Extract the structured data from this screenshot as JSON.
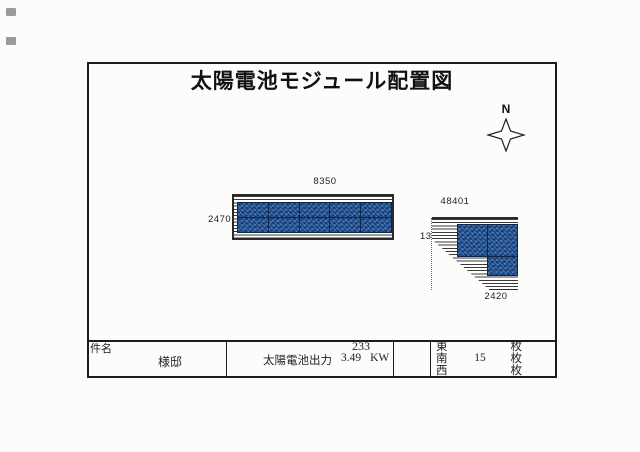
{
  "page": {
    "title": "太陽電池モジュール配置図",
    "compass_label": "N"
  },
  "arrays": {
    "south": {
      "width_label": "8350",
      "height_label": "2470",
      "cols": 5,
      "rows": 2
    },
    "west": {
      "top_label": "48401",
      "left_label": "1350",
      "bottom_label": "2420",
      "module_count": 3
    }
  },
  "titleblock": {
    "project_label": "件名",
    "owner": "様邸",
    "note": "233",
    "output_label": "太陽電池出力",
    "output_value": "3.49",
    "output_unit": "KW",
    "directions": [
      {
        "name": "東",
        "count": "",
        "unit": "枚"
      },
      {
        "name": "南",
        "count": "15",
        "unit": "枚"
      },
      {
        "name": "西",
        "count": "",
        "unit": "枚"
      }
    ]
  },
  "colors": {
    "line": "#1c1c1c",
    "module_blue": "#2e62a8",
    "module_grid": "#0b2848",
    "paper": "#fcfcfb"
  }
}
